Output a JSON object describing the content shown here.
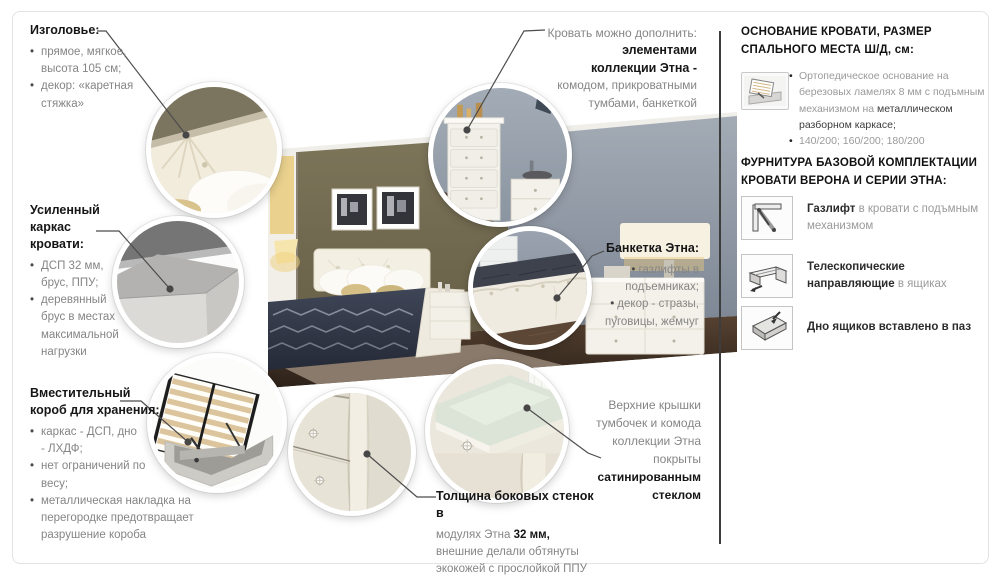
{
  "palette": {
    "leader_line": "#4a4a4a",
    "panel_divider": "#3d3d3d",
    "page_border": "#e3e3e3",
    "title_text": "#161616",
    "body_text": "#858585",
    "wall_olive": "#6f684c",
    "wall_gray": "#8d97a3",
    "floor_brown": "#443429",
    "lamp_glow": "#ecca7e"
  },
  "icons": {
    "base_thumb": "bed-lift-photo",
    "item1": "gas-lift-icon",
    "item2": "telescopic-rails-icon",
    "item3": "drawer-groove-icon"
  },
  "callouts": {
    "headboard": {
      "title": "Изголовье:",
      "items": [
        "прямое, мягкое, высота 105 см;",
        "декор: «каретная стяжка»"
      ]
    },
    "frame": {
      "title": "Усиленный каркас кровати:",
      "items": [
        "ДСП 32 мм, брус, ППУ;",
        "деревянный брус в местах максимальной нагрузки"
      ]
    },
    "storage": {
      "title": "Вместительный короб для хранения:",
      "items": [
        "каркас - ДСП, дно - ЛХДФ;",
        "нет ограничений по весу;",
        "металлическая накладка на перегородке предотвращает разрушение короба"
      ]
    },
    "addons": {
      "lead": "Кровать можно дополнить:",
      "bold": "элементами коллекции Этна -",
      "rest": "комодом, прикроватными тумбами, банкеткой"
    },
    "banquette": {
      "title": "Банкетка Этна:",
      "items": [
        "газлифты в подъемниках;",
        "декор - стразы, пуговицы, жемчуг"
      ]
    },
    "glass": {
      "lead": "Верхние крышки тумбочек и комода коллекции Этна покрыты",
      "bold": "сатинированным стеклом"
    },
    "walls": {
      "bold1": "Толщина боковых стенок в",
      "mid": "модулях Этна ",
      "bold2": "32 мм,",
      "rest": " внешние делали обтянуты экокожей с прослойкой ППУ"
    }
  },
  "panel": {
    "header1": "ОСНОВАНИЕ КРОВАТИ, РАЗМЕР СПАЛЬНОГО МЕСТА Ш/Д, см:",
    "base": {
      "gray": "Ортопедическое основание на березовых ламелях 8 мм с подъмным механизмом на ",
      "dark": "металлическом разборном каркасе;",
      "sizes": "140/200; 160/200; 180/200"
    },
    "header2": "ФУРНИТУРА БАЗОВОЙ КОМПЛЕКТАЦИИ КРОВАТИ ВЕРОНА И СЕРИИ ЭТНА:",
    "items": [
      {
        "bold": "Газлифт",
        "rest": " в кровати с подъмным механизмом"
      },
      {
        "bold": "Телескопические направляющие",
        "rest": " в ящиках"
      },
      {
        "bold": "Дно ящиков вставлено в паз",
        "rest": ""
      }
    ]
  }
}
